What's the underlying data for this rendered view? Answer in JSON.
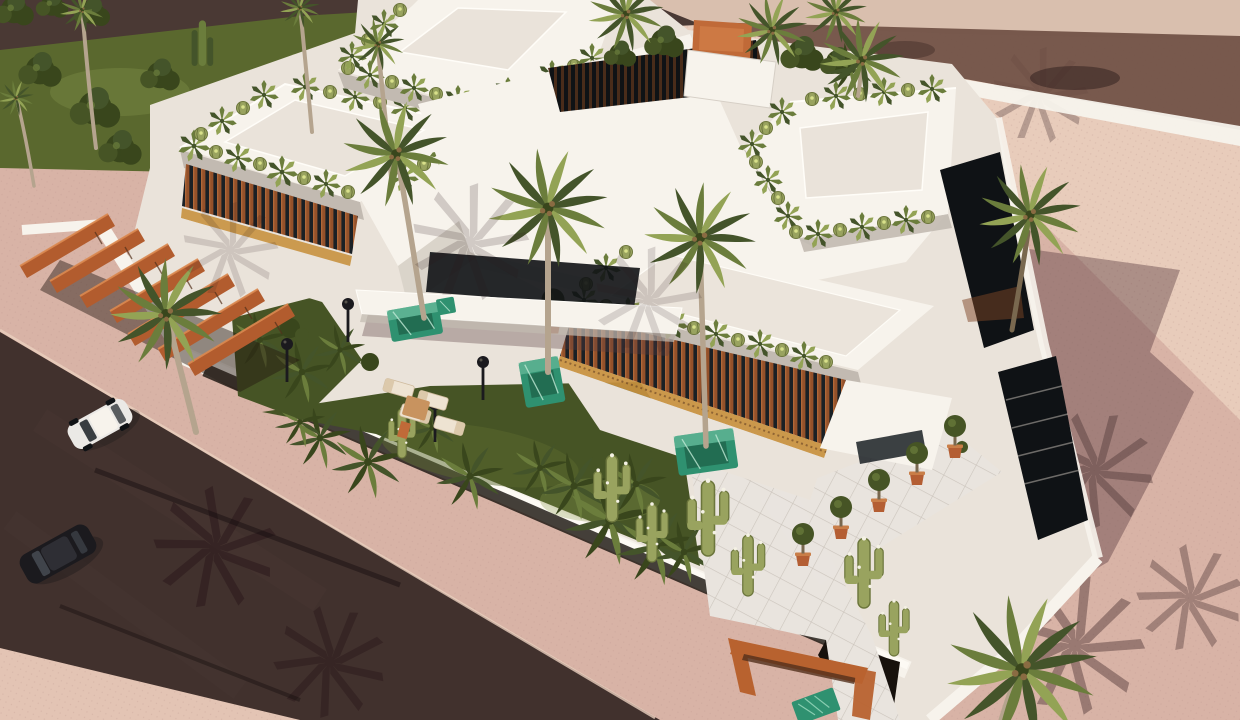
{
  "image": {
    "kind": "3D architectural rendering",
    "view": "aerial bird's-eye view",
    "subject": "Modern flat-roofed white luxury villa complex with rooftop cactus gardens, palm trees, desert landscaping, timber pergola carport and rose-toned paved plaza, bordered by two dark asphalt streets",
    "lighting": "low warm sun casting long palm and building shadows toward the east"
  },
  "palette": {
    "pav_base": "#d8b3a6",
    "pav_light": "#ecd2c0",
    "pav_cool": "#b9938b",
    "road": "#41312d",
    "road_top": "#4a3934",
    "curb": "#eacfbe",
    "lawn": "#5a682e",
    "lawn_dark": "#465425",
    "grass_light": "#8b9a4e",
    "shrub": "#39461c",
    "white_hi": "#f7f3ec",
    "white_mid": "#eae3da",
    "white_low": "#d6cfc6",
    "shade_edge": "#c2bab1",
    "wood": "#94512a",
    "wood_dark": "#53301b",
    "wood_light": "#c97e48",
    "pergola": "#b25c2e",
    "pergola_light": "#da8850",
    "gold": "#c8913f",
    "glass": "#1a2025",
    "void": "#0f1215",
    "teal": "#2f9170",
    "teal_light": "#79c7a7",
    "teal_dark": "#1c5e46",
    "palm_dark": "#44542a",
    "palm_mid": "#6b7d3c",
    "palm_light": "#93a355",
    "trunk": "#b5a48e",
    "trunk_dark": "#79684f",
    "coconut": "#8a6b42",
    "saguaro": "#99a35f",
    "saguaro_dark": "#6c763c",
    "pot_clay": "#b45e33",
    "bench": "#b8622f",
    "car_black": "#1b1a1e",
    "car_white": "#ebe9e6",
    "shadow": "#5d3f42",
    "shadow_deep": "#2a171a",
    "tile": "#e9e4de",
    "tile_line": "#cbc4bc",
    "soil": "#17110c",
    "wall_beige": "#d9bfae",
    "wall_shadow": "#6b4c41",
    "accent_orange": "#c06a38"
  },
  "scene_objects": [
    {
      "name": "villa-buildings",
      "count": 4,
      "detail": "white volumes with rooftop garden borders of agaves and barrel cacti"
    },
    {
      "name": "timber-louver-facades",
      "count": 2,
      "detail": "vertical reddish wood slats with brass-gold trim strips"
    },
    {
      "name": "entrance-canopy",
      "count": 1
    },
    {
      "name": "timber-pergola-carport",
      "beams": 7,
      "location": "west side"
    },
    {
      "name": "green-marble-planters",
      "count": 4
    },
    {
      "name": "palm-trees",
      "count": 14
    },
    {
      "name": "saguaro-cacti",
      "count": 7
    },
    {
      "name": "columnar-cacti",
      "count": 6
    },
    {
      "name": "potted-topiary-trees",
      "count": 5
    },
    {
      "name": "street-lamps",
      "count": 4
    },
    {
      "name": "sun-loungers",
      "count": 4
    },
    {
      "name": "timber-gate-bench",
      "count": 1,
      "location": "south entrance"
    },
    {
      "name": "white-car",
      "count": 1,
      "location": "west street"
    },
    {
      "name": "black-car",
      "count": 1,
      "location": "west street"
    },
    {
      "name": "streets",
      "count": 2,
      "detail": "dark asphalt, north and west"
    },
    {
      "name": "paved-plaza",
      "detail": "rose/pink pavers with long shadows",
      "location": "east"
    },
    {
      "name": "lawn-with-shrubs",
      "location": "northwest corner"
    },
    {
      "name": "interior-gardens",
      "count": 2,
      "detail": "grass, ferns and fan palms"
    }
  ]
}
